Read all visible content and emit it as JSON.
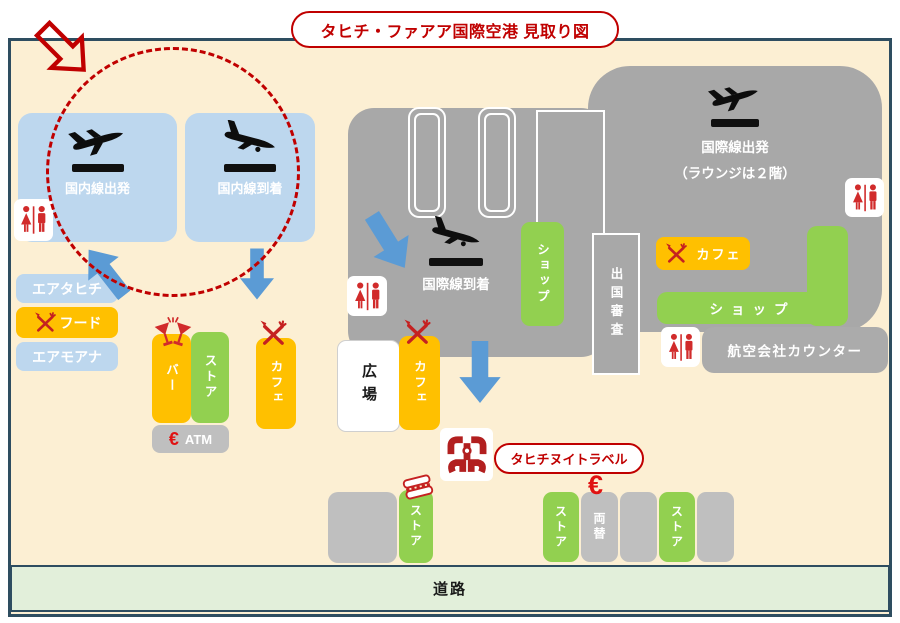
{
  "title": {
    "text": "タヒチ・ファアア国際空港 見取り図"
  },
  "domestic": {
    "departure": "国内線出発",
    "arrival": "国内線到着"
  },
  "airlines": {
    "air_tahiti": "エアタヒチ",
    "food": "フード",
    "air_moana": "エアモアナ"
  },
  "west_shops": {
    "bar": "バー",
    "store": "ストア",
    "atm": "ATM",
    "atm_currency": "€",
    "cafe": "カフェ"
  },
  "plaza": {
    "label": "広場",
    "cafe": "カフェ"
  },
  "international": {
    "arrival": "国際線到着",
    "departure": "国際線出発",
    "departure_note": "（ラウンジは２階）",
    "shop_inner": "ショップ",
    "immigration": "出国審査",
    "cafe": "カフェ",
    "shop_main": "ショップ",
    "airline_counter": "航空会社カウンター"
  },
  "travel_agency": {
    "label": "タヒチヌイトラベル"
  },
  "south_shops": {
    "store1": "ストア",
    "store2": "ストア",
    "store3": "ストア",
    "exchange": "両替",
    "exchange_currency": "€"
  },
  "road": {
    "label": "道路"
  },
  "colors": {
    "accent_red": "#C00000",
    "arrow_blue": "#5B9BD5",
    "terminal_gray": "#A8A8A8",
    "shop_green": "#92D050",
    "food_orange": "#FFC000",
    "airline_blue": "#BDD7EE",
    "background_cream": "#FCEFD3",
    "road_green": "#E2EFDA",
    "border_dark": "#2E4D60"
  }
}
